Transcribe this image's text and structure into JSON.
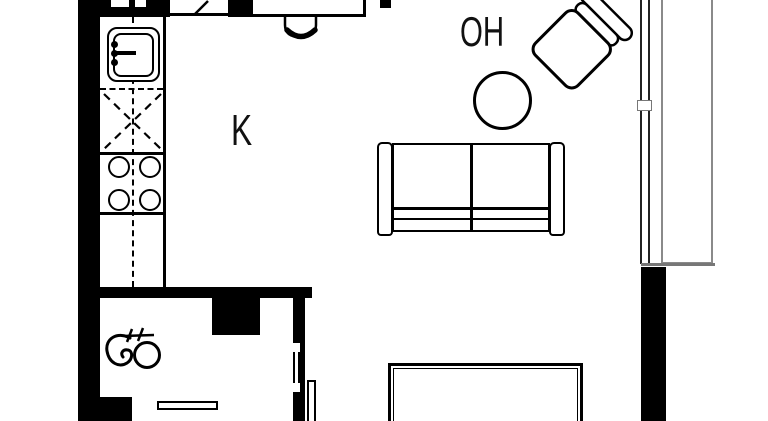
{
  "plan": {
    "labels": {
      "kitchen": "K",
      "living_room": "OH"
    },
    "symbols": [
      "sink-symbol",
      "faucet-symbol",
      "appliance-reserve-dashed-symbol",
      "stove-burner-symbol",
      "dining-chair-symbol",
      "window-diagonal-symbol",
      "table-top-symbol",
      "armchair-symbol",
      "round-table-symbol",
      "sofa-symbol",
      "low-table-symbol",
      "drain-valve-symbol",
      "door-opening-symbol",
      "door-leaf-symbol",
      "balcony-glazing-symbol"
    ],
    "colors": {
      "wall": "#000000",
      "background": "#ffffff",
      "glazing": "#8a8a8a",
      "window_line": "#222222"
    }
  }
}
